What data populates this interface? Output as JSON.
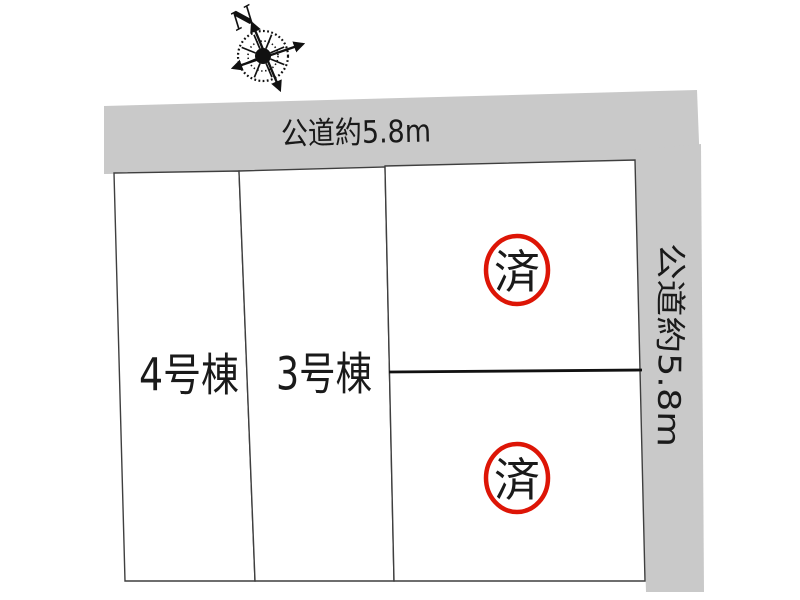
{
  "compass": {
    "north_label": "N"
  },
  "roads": {
    "top": {
      "label": "公道約5.8m",
      "orientation": "horizontal"
    },
    "right": {
      "label": "公道約5.8m",
      "orientation": "vertical"
    }
  },
  "lots": {
    "lot4": {
      "label": "4号棟"
    },
    "lot3": {
      "label": "3号棟"
    },
    "right_upper": {
      "stamp": "済"
    },
    "right_lower": {
      "stamp": "済"
    }
  },
  "colors": {
    "road_fill": "#c9c9c9",
    "lot_border": "#3f3f3f",
    "divider": "#111111",
    "stamp_red": "#dd1506",
    "background": "#ffffff"
  }
}
